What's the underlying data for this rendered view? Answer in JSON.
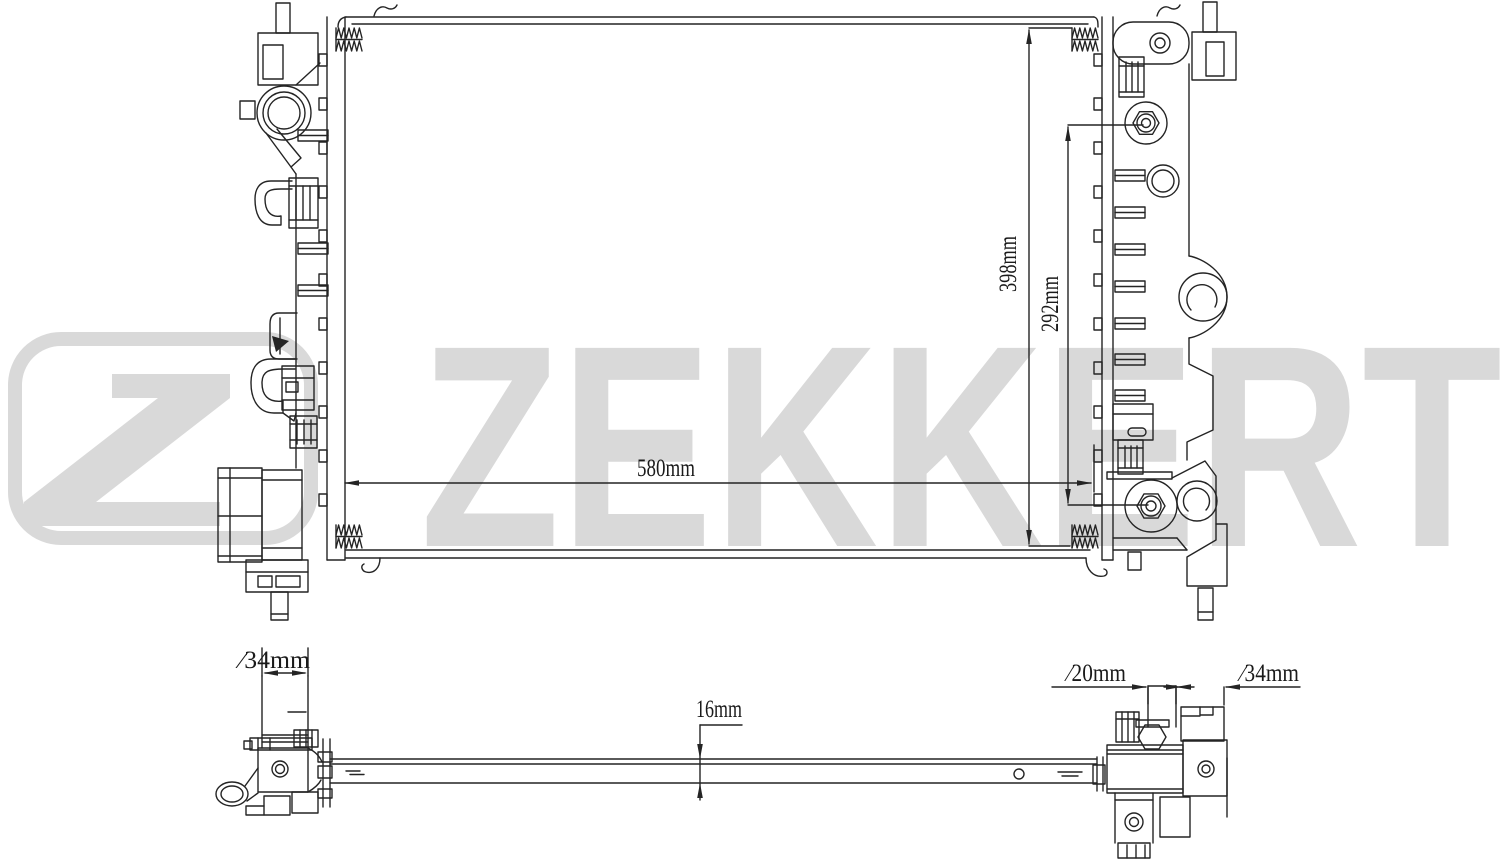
{
  "watermark": {
    "brand_text": "ZEKKERT",
    "logo_letter": "Z",
    "color": "#d9d9d9"
  },
  "front_view": {
    "core_width_label": "580mm",
    "overall_height_label": "398mm",
    "port_spacing_label": "292mm"
  },
  "bottom_view": {
    "inlet_pipe_diameter_label": "∕34mm",
    "core_thickness_label": "16mm",
    "small_pipe_diameter_label": "∕20mm",
    "outlet_pipe_diameter_label": "∕34mm"
  },
  "colors": {
    "background": "#ffffff",
    "line": "#242424",
    "watermark": "#d9d9d9"
  }
}
